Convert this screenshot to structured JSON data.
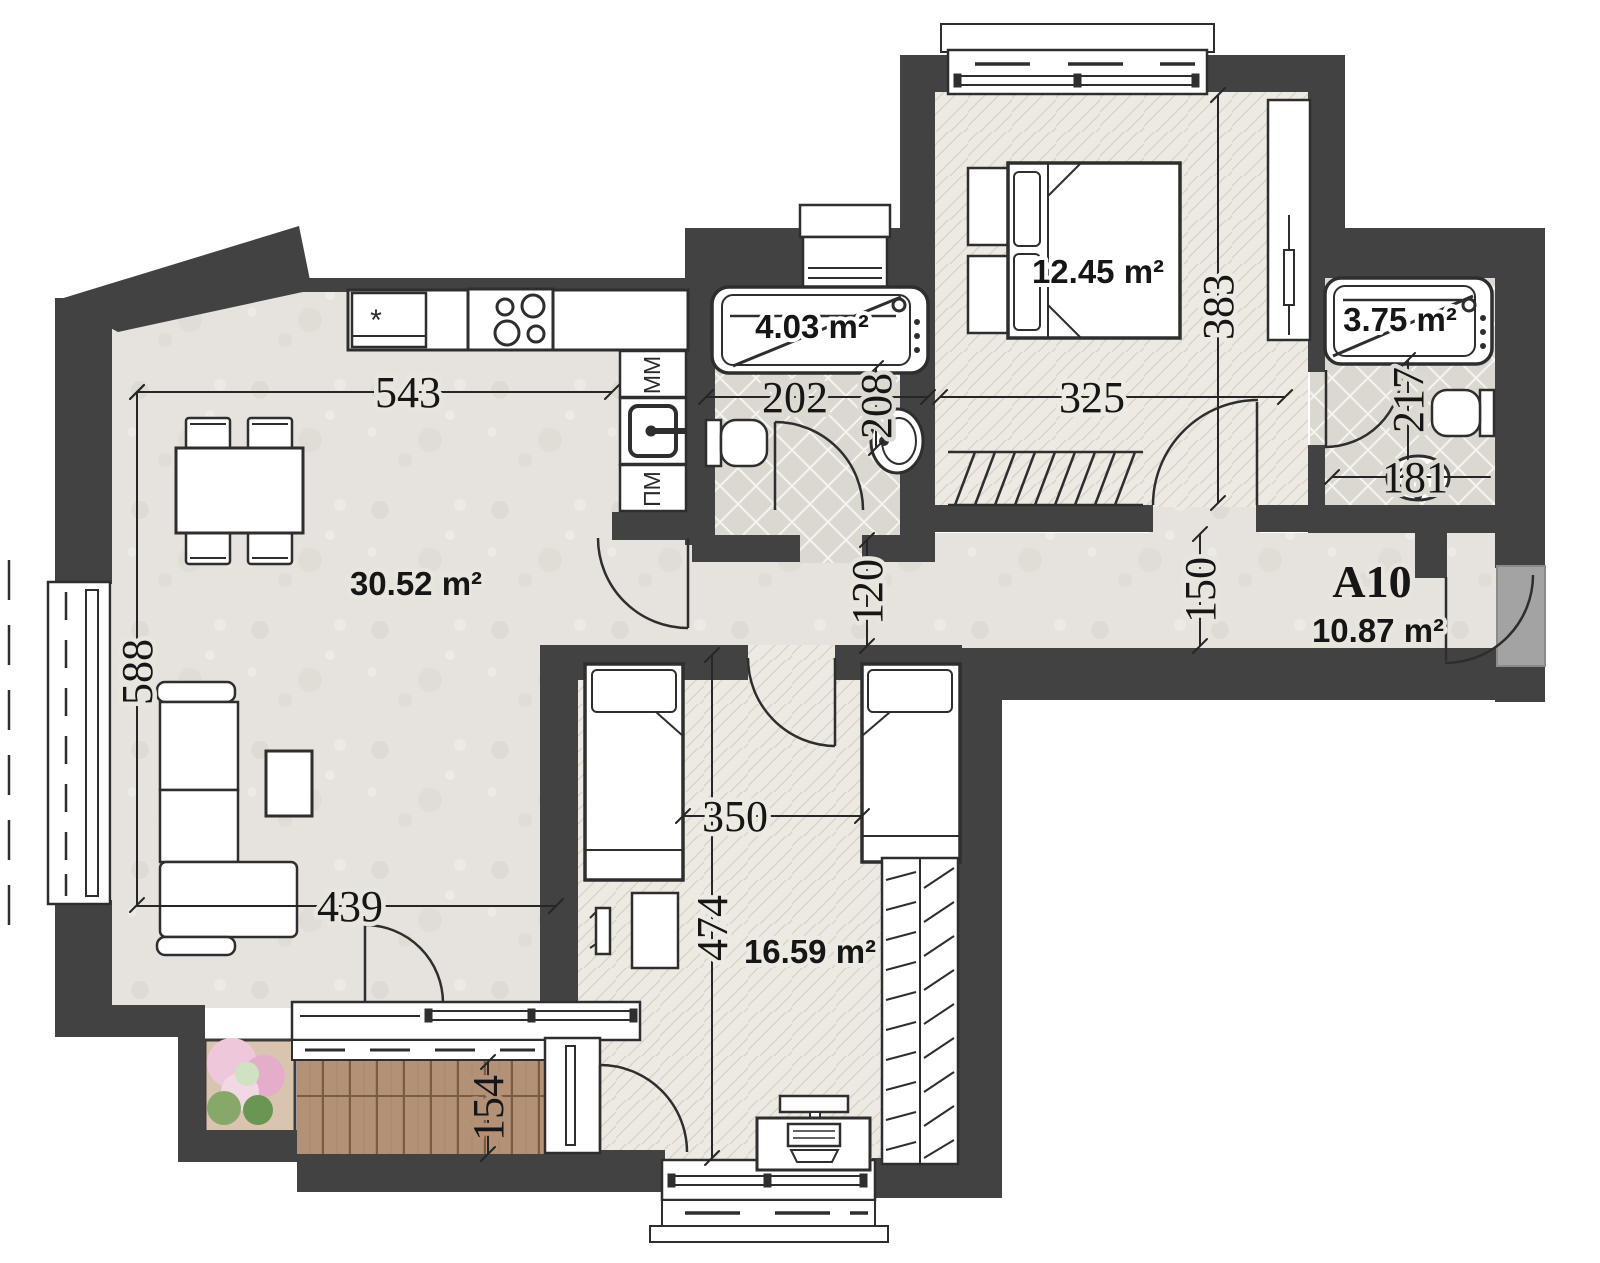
{
  "rooms": {
    "living": {
      "area": "30.52 m²"
    },
    "bedroom": {
      "area": "12.45 m²"
    },
    "kids": {
      "area": "16.59 m²"
    },
    "hall": {
      "code": "A10",
      "area": "10.87 m²"
    },
    "bath_top": {
      "area": "4.03 m²"
    },
    "bath_right": {
      "area": "3.75 m²"
    }
  },
  "dims": {
    "d543": "543",
    "d588": "588",
    "d439": "439",
    "d154": "154",
    "d202": "202",
    "d208": "208",
    "d120": "120",
    "d350": "350",
    "d474": "474",
    "d325": "325",
    "d383": "383",
    "d150": "150",
    "d217": "217",
    "d181": "181"
  },
  "appliances": {
    "washing_machine": "ММ",
    "dishwasher": "ПМ",
    "fridge_mark": "*"
  },
  "colors": {
    "wall": "#424242",
    "deck_wood": "#b29176",
    "threshold": "#a3a3a3"
  }
}
